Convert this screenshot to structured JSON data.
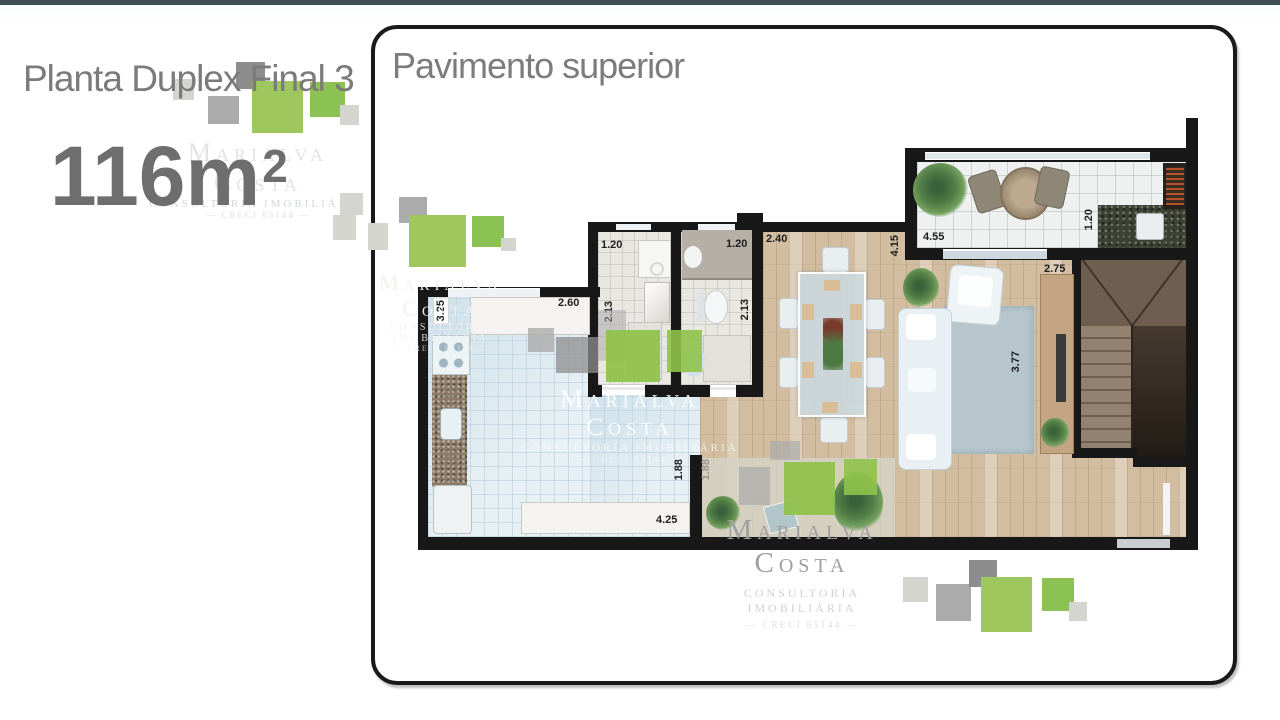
{
  "slide": {
    "title": "Planta Duplex Final 3",
    "area_value": "116m",
    "area_sup": "2",
    "top_bar_color": "#3e4e55"
  },
  "panel": {
    "title": "Pavimento superior"
  },
  "watermark": {
    "line1": "Marialva Costa",
    "line2": "CONSULTORIA IMOBILIÁRIA",
    "line3": "— CRECI 85144 —"
  },
  "palette": {
    "green_large": "#9ec75e",
    "green_medium": "#8cc253",
    "gray_dark": "#8d8d8d",
    "gray_mid": "#ababab",
    "gray_light": "#d5d5d0",
    "title_gray": "#7b7b7b",
    "wall_black": "#181818"
  },
  "plan": {
    "dims": [
      {
        "name": "bath1-width",
        "text": "1.20"
      },
      {
        "name": "bath1-depth",
        "text": "2.13"
      },
      {
        "name": "bath2-width",
        "text": "1.20"
      },
      {
        "name": "bath2-depth",
        "text": "2.13"
      },
      {
        "name": "dining-width",
        "text": "2.40"
      },
      {
        "name": "dining-depth",
        "text": "4.15"
      },
      {
        "name": "terrace-width",
        "text": "4.55"
      },
      {
        "name": "barbecue-width",
        "text": "1.20"
      },
      {
        "name": "stairs-width",
        "text": "2.75"
      },
      {
        "name": "kitchen-width",
        "text": "2.60"
      },
      {
        "name": "kitchen-depth",
        "text": "3.25"
      },
      {
        "name": "living-width",
        "text": "3.77"
      },
      {
        "name": "kitchen-opening",
        "text": "1.88"
      },
      {
        "name": "living-opening",
        "text": "1.88"
      },
      {
        "name": "counter-width",
        "text": "4.25"
      }
    ]
  }
}
